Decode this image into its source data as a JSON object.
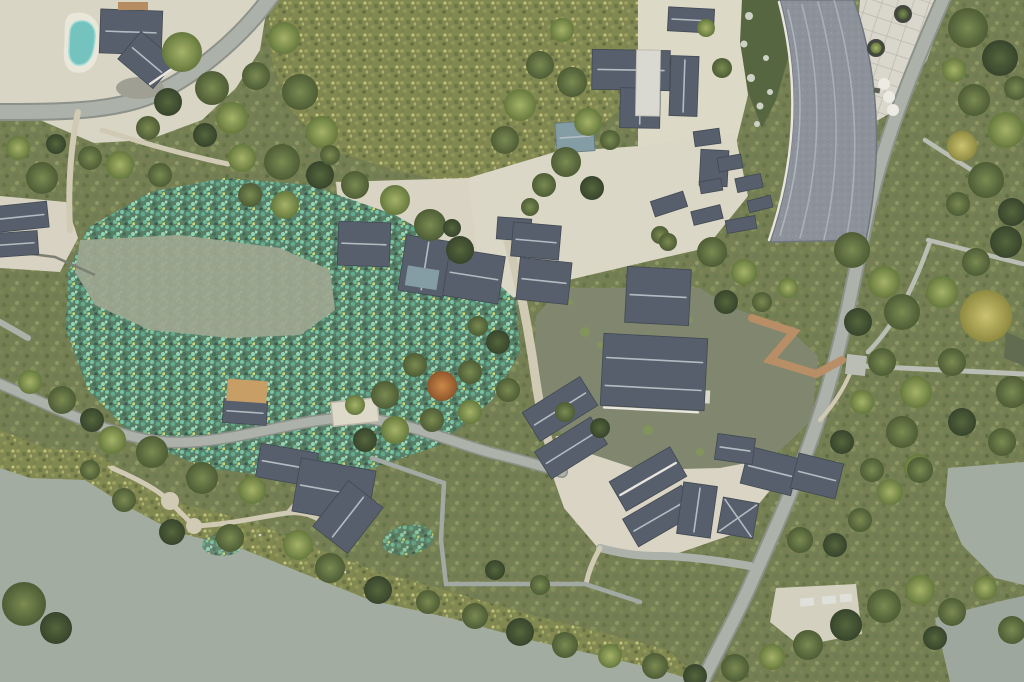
{
  "scene": {
    "type": "aerial-drone-photograph",
    "description": "Top-down drone view of a lakeside traditional Chinese village resort: gray tiled roofs clustered around a green central pond, a large lotus pond, a curved-roof building beside a plaza, winding roads, garden paths, wooden boardwalks, a small swimming pool and a wide gray-green lake along the bottom.",
    "regions": {
      "swimming_pool": "kidney-shaped teal pool on northwest terrace",
      "northwest_house": "dark hip-roof villa beside the pool",
      "lotus_pond": "large speckled teal lotus pond, west-center",
      "open_water_patch": "calm gray opening inside the lotus pond",
      "reed_field": "dense olive reed/lotus field along the top",
      "central_pond": "olive-green courtyard pond ringed by buildings",
      "island_halls": "gray-roof halls on island in central pond",
      "curved_roof_building": "long curved gray roof sweeping along northeast road",
      "northeast_plaza": "grid-paved plaza with planters and umbrellas",
      "canal": "narrow dark-green canal with stones",
      "lake": "wide gray-green lake across the bottom",
      "wooden_boardwalk": "tan zigzag boardwalk northeast of pond",
      "lakeside_boardwalk": "thin gray zigzag boardwalk through shore reeds",
      "pavilion": "square pavilion roof with X ridge, south village"
    }
  },
  "palette": {
    "veg_base": "#6f7a4b",
    "lake": "#9fa99e",
    "pond": "#7b8268",
    "pool": "#6ec1bd",
    "roof": "#4e5865",
    "roof_edge": "#39414b",
    "roof_light": "#d9d8d0",
    "roof_curved": "#888e96",
    "ridge": "#b2b9c0",
    "road": "#a9aea6",
    "road_dark": "#8f958b",
    "path": "#cfc9b2",
    "plaza": "#d9d4c2",
    "boardwalk_wood": "#b5895e",
    "boardwalk_gray": "#b7bbb0",
    "canal": "#4f5f38",
    "reed": "#7d8349",
    "lotus_teal": "#6fc2a0",
    "open_water": "#9aa38c",
    "wall_white": "#e8e6df",
    "teal_roof": "#7f99a1",
    "tan_deck": "#c59a5f",
    "tree_orange": "#c98440",
    "tree_gold": "#c9c06a"
  }
}
